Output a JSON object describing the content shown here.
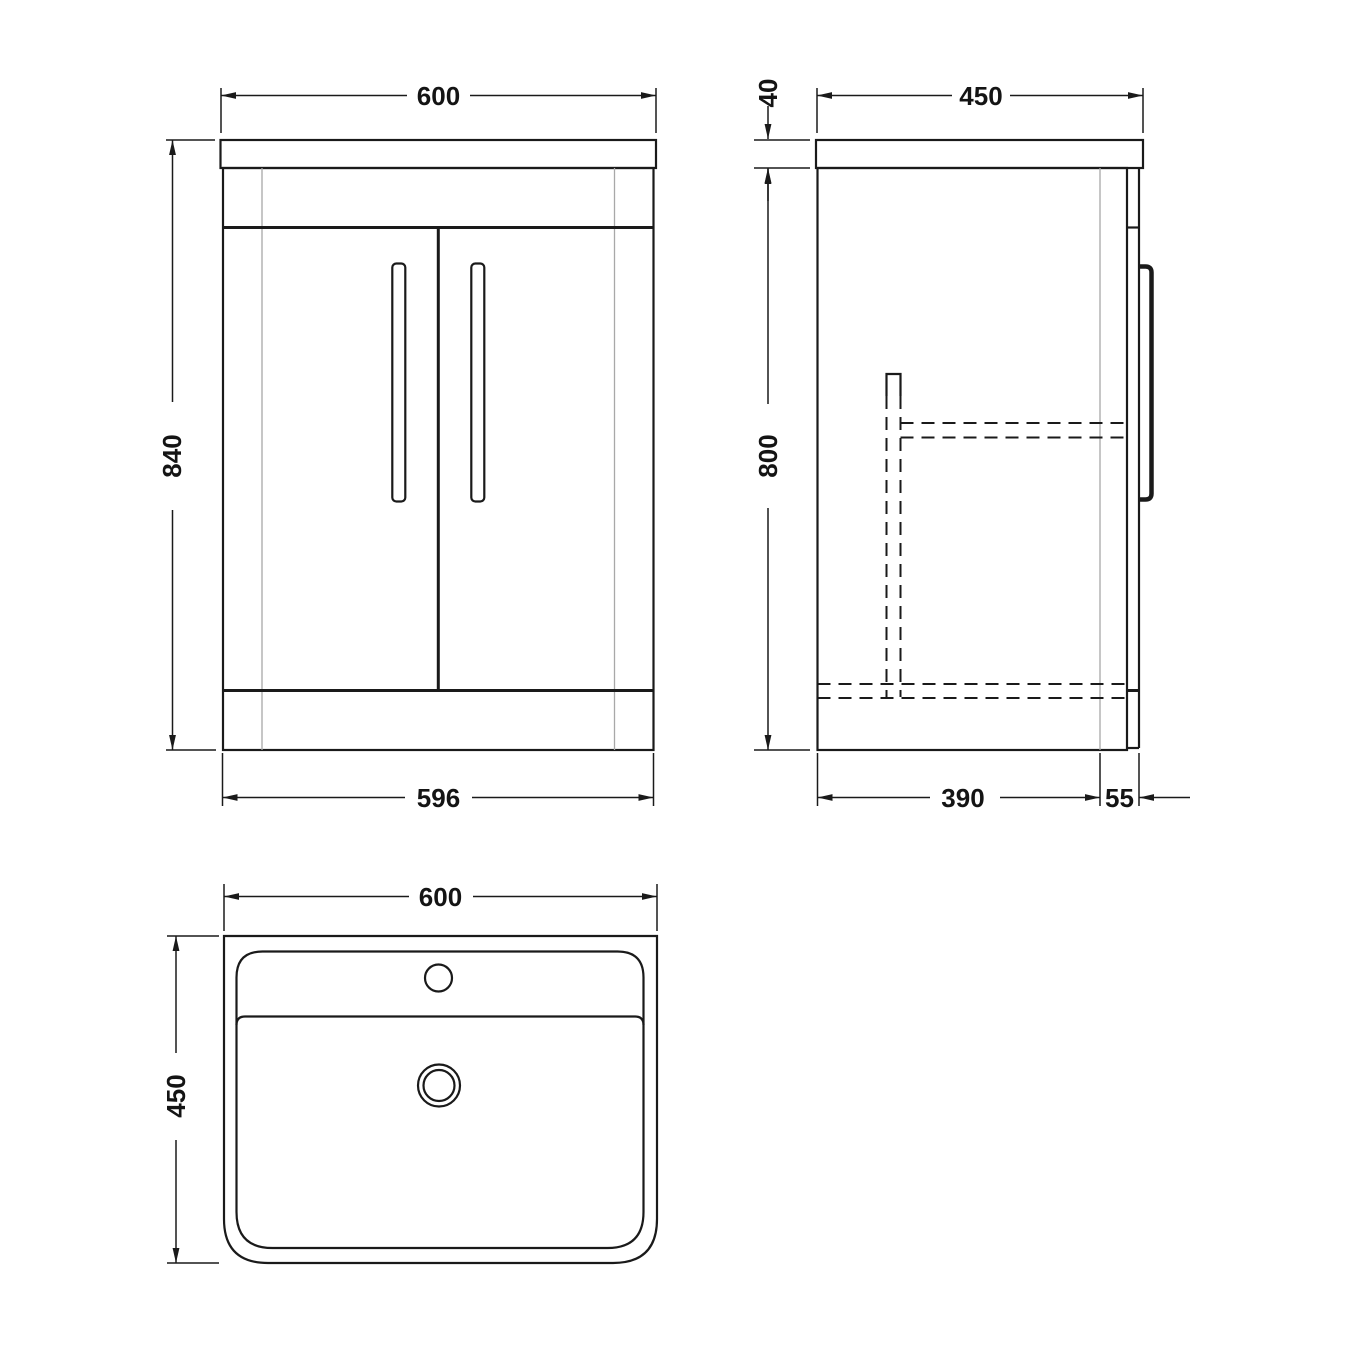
{
  "colors": {
    "background": "#ffffff",
    "line": "#1a1a1a",
    "thin_line": "#a8a8a8"
  },
  "views": {
    "front": {
      "dimensions": {
        "width_top": "600",
        "height": "840",
        "width_bottom": "596"
      }
    },
    "side": {
      "dimensions": {
        "depth_top": "450",
        "counter_thickness": "40",
        "body_height": "800",
        "depth_bottom": "390",
        "front_offset": "55"
      }
    },
    "plan": {
      "dimensions": {
        "width": "600",
        "depth": "450"
      }
    }
  }
}
